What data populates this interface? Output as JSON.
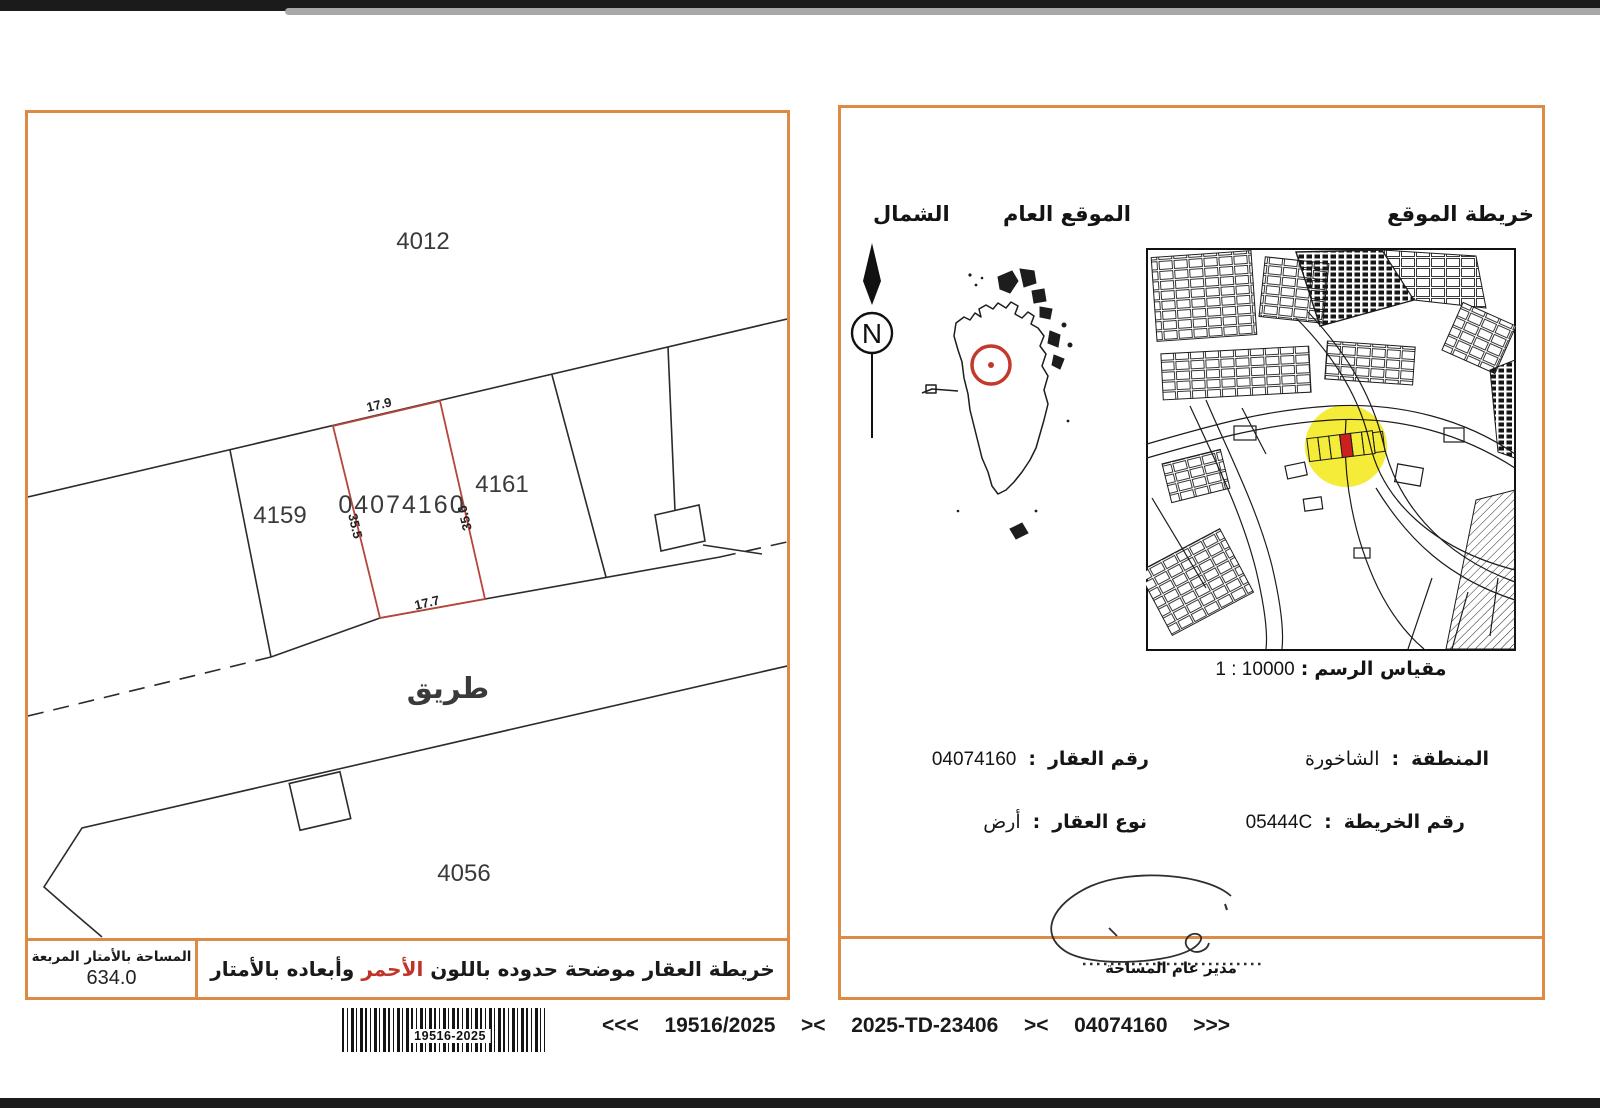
{
  "plot_panel": {
    "parcels": {
      "p4012": "4012",
      "p4159": "4159",
      "p4161": "4161",
      "p4056": "4056",
      "subject": "04074160"
    },
    "road": "طريق",
    "dims": {
      "top": "17.9",
      "bottom": "17.7",
      "left": "35.5",
      "right": "35.6"
    },
    "area_label": "المساحة بالأمتار المربعة",
    "area_value": "634.0",
    "note": {
      "before": "خريطة العقار موضحة حدوده باللون",
      "red": "الأحمر",
      "after": "وأبعاده بالأمتار"
    }
  },
  "location_panel": {
    "title": "خريطة الموقع",
    "general_location": "الموقع العام",
    "north": "الشمال",
    "compass_letter": "N",
    "scale_numbers": "1 : 10000",
    "scale_separator": ":",
    "scale_label": "مقياس الرسم",
    "fields": {
      "colon": ":",
      "region_label": "المنطقة",
      "region_value": "الشاخورة",
      "map_no_label": "رقم الخريطة",
      "map_no_value": "05444C",
      "parcel_label": "رقم العقار",
      "parcel_value": "04074160",
      "type_label": "نوع العقار",
      "type_value": "أرض"
    },
    "signature_caption": "مدير عام المساحة"
  },
  "footer": {
    "barcode_text": "19516-2025",
    "refs": [
      "<<<",
      "19516/2025",
      "><",
      "2025-TD-23406",
      "><",
      "04074160",
      ">>>"
    ]
  },
  "colors": {
    "accent_orange": "#dd8a45",
    "boundary_red": "#b5463c",
    "highlight_yellow": "#f5ec39",
    "subject_red": "#cc1f1f"
  }
}
